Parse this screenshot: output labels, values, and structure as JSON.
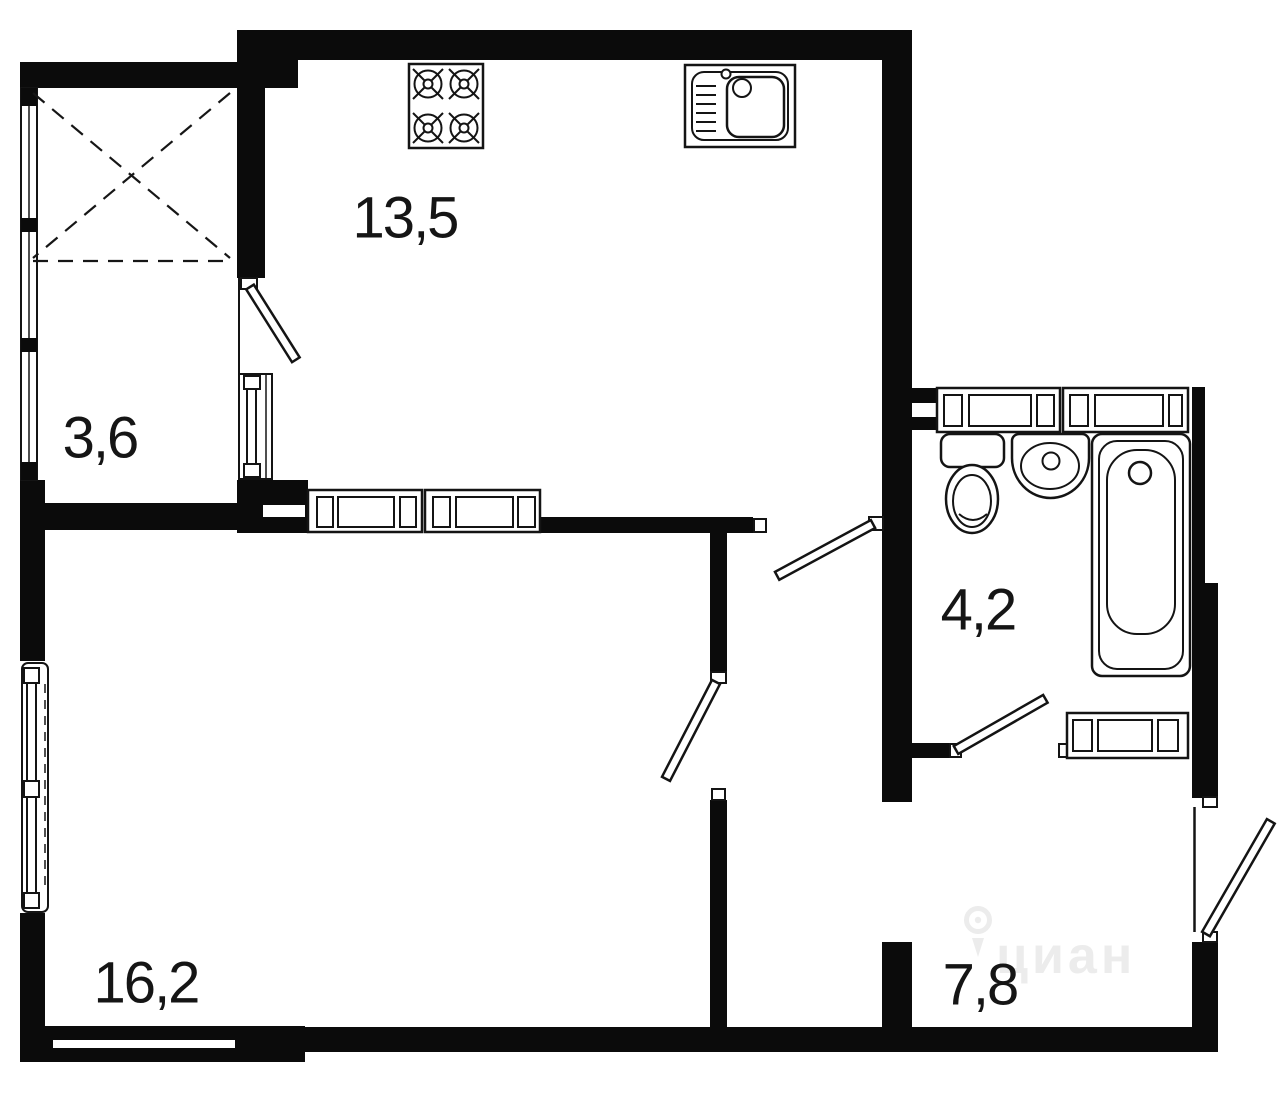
{
  "canvas": {
    "background": "#ffffff",
    "wall_color": "#0b0b0b",
    "line_color": "#141414",
    "label_color": "#151515",
    "watermark_color": "#ececec"
  },
  "plan": {
    "type": "apartment-floor-plan",
    "rooms": {
      "kitchen": {
        "area": "13,5"
      },
      "loggia": {
        "area": "3,6"
      },
      "bathroom": {
        "area": "4,2"
      },
      "living_room": {
        "area": "16,2"
      },
      "hallway": {
        "area": "7,8"
      }
    },
    "fixtures": [
      "stove-icon",
      "kitchen-sink-icon",
      "kitchen-cabinets-icon",
      "washer-cabinets-icon",
      "toilet-icon",
      "washbasin-icon",
      "bathtub-icon",
      "hall-cabinet-icon",
      "window-icon",
      "door-leaf-icon",
      "wardrobe-cross-icon"
    ]
  },
  "watermark": {
    "text": "циан",
    "icon": "map-pin-icon"
  }
}
